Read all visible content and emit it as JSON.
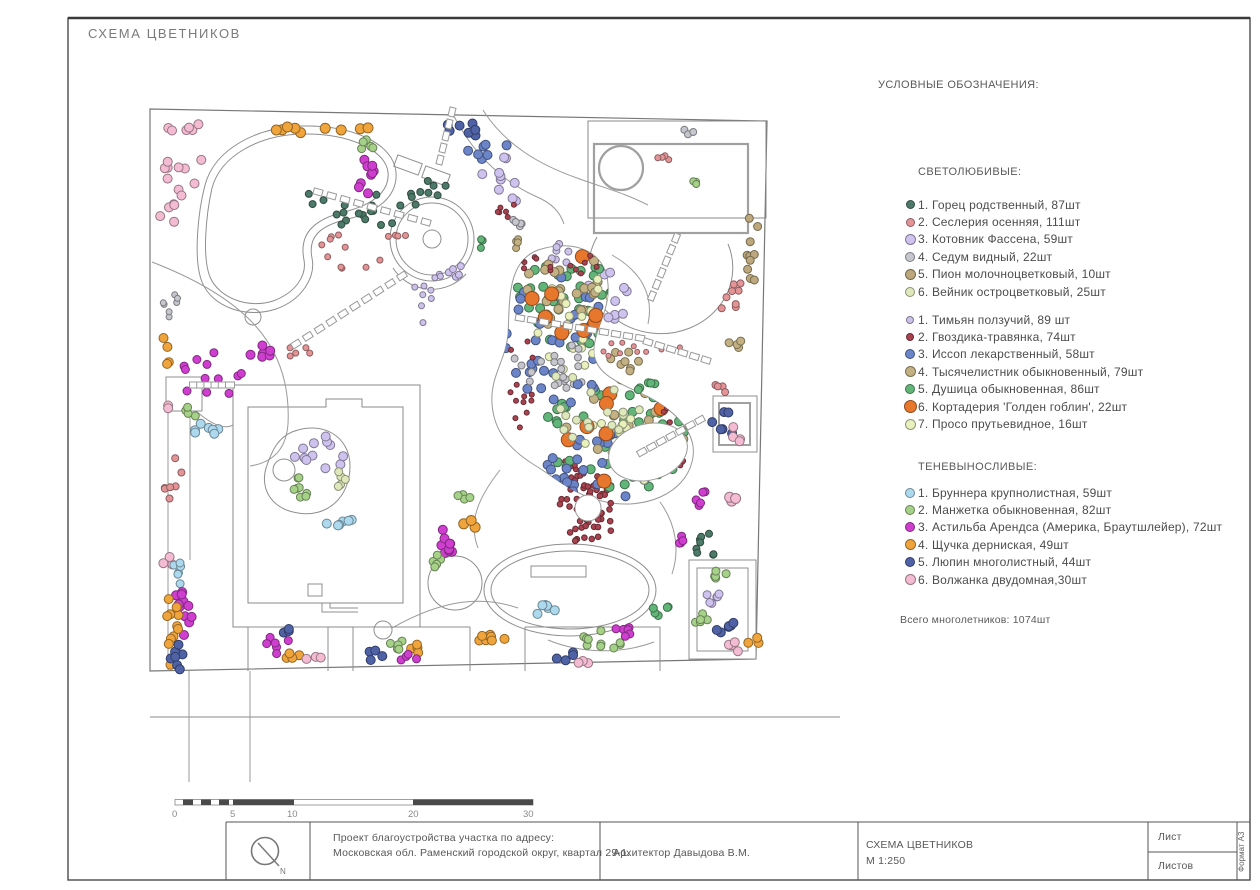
{
  "page": {
    "title": "СХЕМА ЦВЕТНИКОВ"
  },
  "legend": {
    "header": "УСЛОВНЫЕ ОБОЗНАЧЕНИЯ:",
    "total": "Всего многолетников: 1074шт",
    "groups": [
      {
        "title": "СВЕТОЛЮБИВЫЕ:",
        "items": [
          {
            "label": "1. Горец родственный, 87шт",
            "key": "dg",
            "size": 9
          },
          {
            "label": "2. Сеслерия осенняя, 111шт",
            "key": "se",
            "size": 9
          },
          {
            "label": "3. Котовник Фассена, 59шт",
            "key": "kt",
            "size": 11
          },
          {
            "label": "4. Седум видный, 22шт",
            "key": "sd",
            "size": 10
          },
          {
            "label": "5. Пион молочноцветковый, 10шт",
            "key": "pn",
            "size": 11
          },
          {
            "label": "6. Вейник остроцветковый, 25шт",
            "key": "vn",
            "size": 10
          }
        ]
      },
      {
        "title": "",
        "items": [
          {
            "label": "1. Тимьян ползучий, 89 шт",
            "key": "tm",
            "size": 8
          },
          {
            "label": "2. Гвоздика-травянка, 74шт",
            "key": "gv",
            "size": 8
          },
          {
            "label": "3. Иссоп лекарственный, 58шт",
            "key": "is",
            "size": 10
          },
          {
            "label": "4. Тысячелистник обыкновенный, 79шт",
            "key": "ts",
            "size": 11
          },
          {
            "label": "5. Душица обыкновенная, 86шт",
            "key": "du",
            "size": 10
          },
          {
            "label": "6. Кортадерия 'Голден гоблин', 22шт",
            "key": "ko",
            "size": 13
          },
          {
            "label": "7. Просо прутьевидное, 16шт",
            "key": "pr",
            "size": 11
          }
        ]
      },
      {
        "title": "ТЕНЕВЫНОСЛИВЫЕ:",
        "items": [
          {
            "label": "1. Бруннера крупнолистная, 59шт",
            "key": "br",
            "size": 10
          },
          {
            "label": "2. Манжетка обыкновенная, 82шт",
            "key": "mn",
            "size": 10
          },
          {
            "label": "3. Астильба Арендса (Америка, Браутшлейер), 72шт",
            "key": "as",
            "size": 10
          },
          {
            "label": "4. Щучка дерниская, 49шт",
            "key": "sh",
            "size": 11
          },
          {
            "label": "5. Люпин многолистный, 44шт",
            "key": "lu",
            "size": 10
          },
          {
            "label": "6. Волжанка двудомная,30шт",
            "key": "vl",
            "size": 11
          }
        ]
      }
    ]
  },
  "titleblock": {
    "project_line1": "Проект благоустройства участка по адресу:",
    "project_line2": "Московская обл. Раменский городской округ, квартал 29-1.",
    "architect": "Архитектор  Давыдова В.М.",
    "scheme_name": "СХЕМА ЦВЕТНИКОВ",
    "scale": "М 1:250",
    "sheet_label": "Лист",
    "sheets_label": "Листов",
    "format": "Формат А3",
    "north_label": "N"
  },
  "scalebar": {
    "labels": [
      "0",
      "5",
      "10",
      "20",
      "30"
    ]
  },
  "plan": {
    "palette": {
      "dg": "#4d7a68",
      "se": "#e39497",
      "kt": "#cec2ee",
      "sd": "#c6c6ce",
      "pn": "#bca87c",
      "vn": "#dfe8bb",
      "tm": "#cdc2ea",
      "gv": "#a84350",
      "is": "#6b85c8",
      "ts": "#c3b183",
      "du": "#62b578",
      "ko": "#e8772e",
      "pr": "#e9f0bc",
      "br": "#add9ef",
      "mn": "#a6d189",
      "as": "#cf3fcf",
      "sh": "#f0a43c",
      "lu": "#4f62a6",
      "vl": "#f4bcd2"
    },
    "clusters": [
      [
        183,
        152,
        26,
        36,
        14,
        4.5,
        "vl",
        0
      ],
      [
        172,
        212,
        12,
        28,
        7,
        4.5,
        "vl",
        0
      ],
      [
        170,
        300,
        8,
        20,
        7,
        3,
        "sd",
        0
      ],
      [
        167,
        352,
        6,
        20,
        4,
        4.5,
        "sh",
        0
      ],
      [
        213,
        382,
        34,
        32,
        12,
        4,
        "as",
        0
      ],
      [
        172,
        480,
        10,
        26,
        7,
        3.5,
        "se",
        0
      ],
      [
        170,
        560,
        8,
        8,
        3,
        4.5,
        "vl",
        0
      ],
      [
        181,
        572,
        9,
        13,
        6,
        4,
        "br",
        0
      ],
      [
        184,
        606,
        9,
        30,
        11,
        4.5,
        "as",
        0
      ],
      [
        173,
        627,
        7,
        42,
        12,
        4.5,
        "sh",
        0
      ],
      [
        178,
        656,
        9,
        14,
        7,
        4.5,
        "lu",
        0
      ],
      [
        312,
        130,
        68,
        4,
        9,
        5,
        "sh",
        0
      ],
      [
        465,
        127,
        33,
        9,
        8,
        4.5,
        "lu",
        0
      ],
      [
        482,
        149,
        26,
        12,
        7,
        4.5,
        "is",
        0
      ],
      [
        360,
        204,
        58,
        24,
        22,
        3.5,
        "dg",
        0
      ],
      [
        432,
        186,
        18,
        11,
        6,
        3.5,
        "dg",
        0
      ],
      [
        362,
        252,
        42,
        26,
        10,
        3,
        "se",
        0
      ],
      [
        368,
        177,
        16,
        18,
        9,
        4.5,
        "as",
        0
      ],
      [
        262,
        352,
        16,
        8,
        6,
        4.5,
        "as",
        0
      ],
      [
        297,
        352,
        13,
        7,
        5,
        3,
        "se",
        0
      ],
      [
        366,
        146,
        11,
        9,
        5,
        4,
        "mn",
        0
      ],
      [
        500,
        182,
        24,
        26,
        10,
        4.5,
        "kt",
        0
      ],
      [
        560,
        253,
        18,
        12,
        8,
        3.5,
        "tm",
        0
      ],
      [
        607,
        296,
        22,
        26,
        11,
        4.5,
        "kt",
        0
      ],
      [
        622,
        360,
        20,
        12,
        8,
        4,
        "ts",
        0
      ],
      [
        566,
        382,
        18,
        11,
        7,
        3.5,
        "sd",
        0
      ],
      [
        648,
        386,
        12,
        8,
        5,
        4,
        "du",
        0
      ],
      [
        655,
        350,
        62,
        10,
        10,
        2.5,
        "se",
        0
      ],
      [
        752,
        242,
        6,
        44,
        10,
        4,
        "pn",
        0
      ],
      [
        733,
        302,
        13,
        24,
        8,
        3.5,
        "se",
        0
      ],
      [
        735,
        342,
        10,
        8,
        4,
        4,
        "ts",
        0
      ],
      [
        723,
        425,
        11,
        17,
        6,
        4.5,
        "lu",
        0
      ],
      [
        738,
        433,
        7,
        9,
        4,
        4.5,
        "vl",
        0
      ],
      [
        720,
        390,
        8,
        8,
        4,
        3.5,
        "se",
        0
      ],
      [
        700,
        497,
        9,
        9,
        5,
        4,
        "as",
        0
      ],
      [
        731,
        502,
        6,
        7,
        3,
        5,
        "vl",
        0
      ],
      [
        682,
        540,
        8,
        7,
        4,
        4,
        "as",
        0
      ],
      [
        706,
        545,
        13,
        18,
        8,
        3.5,
        "dg",
        0
      ],
      [
        718,
        575,
        11,
        7,
        5,
        4,
        "mn",
        0
      ],
      [
        713,
        600,
        11,
        9,
        6,
        4,
        "kt",
        0
      ],
      [
        727,
        628,
        11,
        9,
        6,
        4.5,
        "lu",
        0
      ],
      [
        734,
        648,
        8,
        6,
        4,
        4.5,
        "vl",
        0
      ],
      [
        700,
        620,
        10,
        7,
        5,
        4,
        "mn",
        0
      ],
      [
        753,
        641,
        6,
        8,
        3,
        4.5,
        "sh",
        0
      ],
      [
        545,
        607,
        13,
        9,
        6,
        4.5,
        "br",
        0
      ],
      [
        600,
        641,
        23,
        11,
        10,
        4,
        "mn",
        0
      ],
      [
        621,
        632,
        16,
        7,
        6,
        4,
        "as",
        0
      ],
      [
        490,
        638,
        27,
        4,
        8,
        4.5,
        "sh",
        0
      ],
      [
        660,
        610,
        10,
        8,
        5,
        4,
        "du",
        0
      ],
      [
        563,
        654,
        11,
        7,
        4,
        4.5,
        "lu",
        0
      ],
      [
        585,
        660,
        8,
        5,
        3,
        4.5,
        "vl",
        0
      ],
      [
        277,
        645,
        13,
        9,
        6,
        4,
        "as",
        0
      ],
      [
        296,
        657,
        11,
        5,
        4,
        4.5,
        "sh",
        0
      ],
      [
        288,
        632,
        7,
        5,
        3,
        4.5,
        "lu",
        0
      ],
      [
        313,
        660,
        9,
        5,
        3,
        4.5,
        "vl",
        0
      ],
      [
        398,
        645,
        14,
        8,
        5,
        4,
        "mn",
        0
      ],
      [
        420,
        650,
        10,
        6,
        4,
        4.5,
        "sh",
        0
      ],
      [
        408,
        658,
        9,
        5,
        4,
        4,
        "as",
        0
      ],
      [
        374,
        656,
        9,
        6,
        4,
        4.5,
        "lu",
        0
      ],
      [
        200,
        430,
        24,
        8,
        7,
        4.5,
        "br",
        0
      ],
      [
        167,
        412,
        5,
        7,
        2,
        4.5,
        "vl",
        0
      ],
      [
        190,
        412,
        9,
        5,
        4,
        4,
        "mn",
        0
      ],
      [
        320,
        452,
        26,
        20,
        12,
        4.5,
        "kt",
        0
      ],
      [
        301,
        487,
        18,
        11,
        8,
        4,
        "mn",
        0
      ],
      [
        336,
        479,
        10,
        8,
        5,
        4,
        "vn",
        0
      ],
      [
        338,
        519,
        16,
        8,
        6,
        4.5,
        "br",
        0
      ],
      [
        448,
        538,
        13,
        16,
        9,
        4.5,
        "as",
        0
      ],
      [
        433,
        560,
        10,
        7,
        5,
        4,
        "mn",
        0
      ],
      [
        470,
        524,
        7,
        6,
        3,
        5,
        "sh",
        0
      ],
      [
        464,
        500,
        8,
        7,
        4,
        4,
        "mn",
        0
      ],
      [
        430,
        300,
        28,
        28,
        10,
        3,
        "tm",
        0
      ],
      [
        396,
        234,
        10,
        7,
        4,
        3,
        "se",
        0
      ],
      [
        505,
        210,
        14,
        8,
        6,
        2.5,
        "gv",
        0
      ],
      [
        516,
        226,
        10,
        8,
        5,
        3.5,
        "sd",
        0
      ],
      [
        521,
        245,
        9,
        7,
        4,
        3.5,
        "ts",
        0
      ],
      [
        482,
        244,
        9,
        7,
        4,
        3.5,
        "du",
        0
      ],
      [
        456,
        270,
        10,
        8,
        5,
        3.5,
        "kt",
        0
      ],
      [
        692,
        182,
        9,
        6,
        4,
        3.5,
        "mn",
        0
      ],
      [
        661,
        160,
        8,
        6,
        4,
        3,
        "se",
        0
      ],
      [
        688,
        130,
        7,
        5,
        3,
        3.5,
        "sd",
        0
      ],
      [
        588,
        508,
        32,
        36,
        52,
        2.8,
        "gv",
        0
      ],
      [
        570,
        470,
        18,
        9,
        9,
        2.5,
        "gv",
        0
      ],
      [
        565,
        298,
        52,
        52,
        42,
        4.5,
        "du",
        1
      ],
      [
        612,
        440,
        76,
        56,
        42,
        4.5,
        "du",
        1
      ],
      [
        558,
        340,
        55,
        65,
        36,
        4.5,
        "is",
        1
      ],
      [
        592,
        468,
        66,
        38,
        28,
        4.5,
        "is",
        1
      ],
      [
        572,
        292,
        48,
        42,
        32,
        4.5,
        "ts",
        1
      ],
      [
        632,
        422,
        66,
        48,
        28,
        4.5,
        "ts",
        1
      ],
      [
        580,
        320,
        46,
        55,
        22,
        4,
        "pr",
        1
      ],
      [
        622,
        450,
        56,
        38,
        14,
        4,
        "pr",
        1
      ],
      [
        574,
        300,
        42,
        46,
        9,
        7,
        "ko",
        1
      ],
      [
        612,
        440,
        66,
        52,
        11,
        7,
        "ko",
        1
      ],
      [
        560,
        262,
        48,
        14,
        14,
        2.5,
        "gv",
        1
      ],
      [
        520,
        380,
        14,
        55,
        14,
        2.5,
        "gv",
        1
      ],
      [
        678,
        432,
        18,
        46,
        11,
        2.5,
        "gv",
        1
      ],
      [
        546,
        360,
        36,
        28,
        14,
        3.5,
        "sd",
        1
      ],
      [
        600,
        400,
        55,
        46,
        18,
        4,
        "vn",
        1
      ],
      [
        638,
        472,
        36,
        22,
        11,
        3,
        "tm",
        1
      ]
    ],
    "chains": [
      [
        318,
        192,
        426,
        222,
        9
      ],
      [
        296,
        344,
        402,
        276,
        10
      ],
      [
        520,
        318,
        640,
        338,
        11
      ],
      [
        648,
        342,
        706,
        360,
        6
      ],
      [
        452,
        112,
        440,
        160,
        5
      ],
      [
        676,
        238,
        652,
        296,
        6
      ],
      [
        700,
        420,
        642,
        452,
        7
      ],
      [
        194,
        385,
        230,
        385,
        6
      ]
    ]
  }
}
